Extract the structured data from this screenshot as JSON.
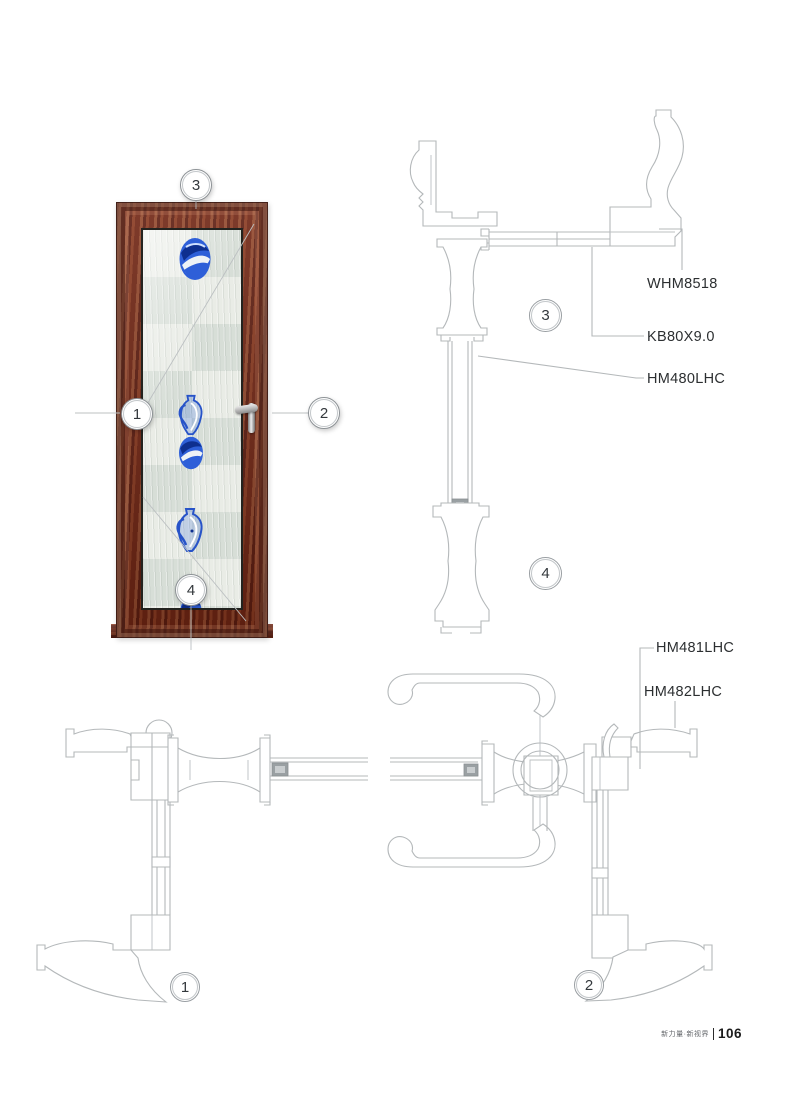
{
  "callouts": {
    "c1": "1",
    "c2": "2",
    "c3": "3",
    "c4": "4"
  },
  "part_labels": {
    "whm8518": "WHM8518",
    "kb80x9_0": "KB80X9.0",
    "hm480lhc": "HM480LHC",
    "hm481lhc": "HM481LHC",
    "hm482lhc": "HM482LHC"
  },
  "footer": {
    "brand": "新力量·新视界",
    "page": "106"
  },
  "colors": {
    "wood": "#7a2c18",
    "glass": "#e3e8e2",
    "motif_blue": "#2e5fd8",
    "cad_line": "#b4b8ba"
  }
}
